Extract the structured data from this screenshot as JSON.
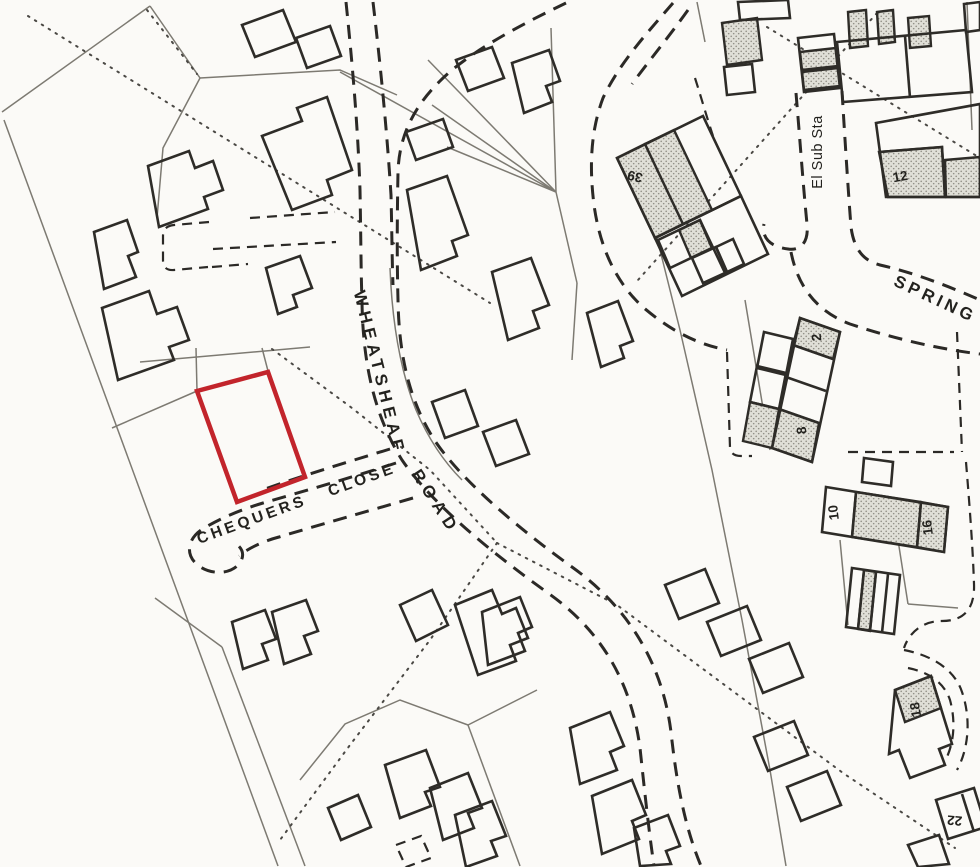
{
  "map": {
    "street_labels": {
      "wheatsheaf": "WHEATSHEAF",
      "road": "ROAD",
      "chequers_close": "CHEQUERS CLOSE",
      "spring": "SPRING"
    },
    "features": {
      "el_sub_sta": "El Sub Sta"
    },
    "house_numbers": {
      "n39": "39",
      "n12": "12",
      "n2": "2",
      "n8": "8",
      "n10": "10",
      "n16": "16",
      "n18": "18",
      "n22": "22"
    },
    "colors": {
      "plot_outline": "#c2242b",
      "line": "#2e2c28",
      "thin_line": "#7d7a72",
      "background": "#fbfaf7"
    }
  }
}
